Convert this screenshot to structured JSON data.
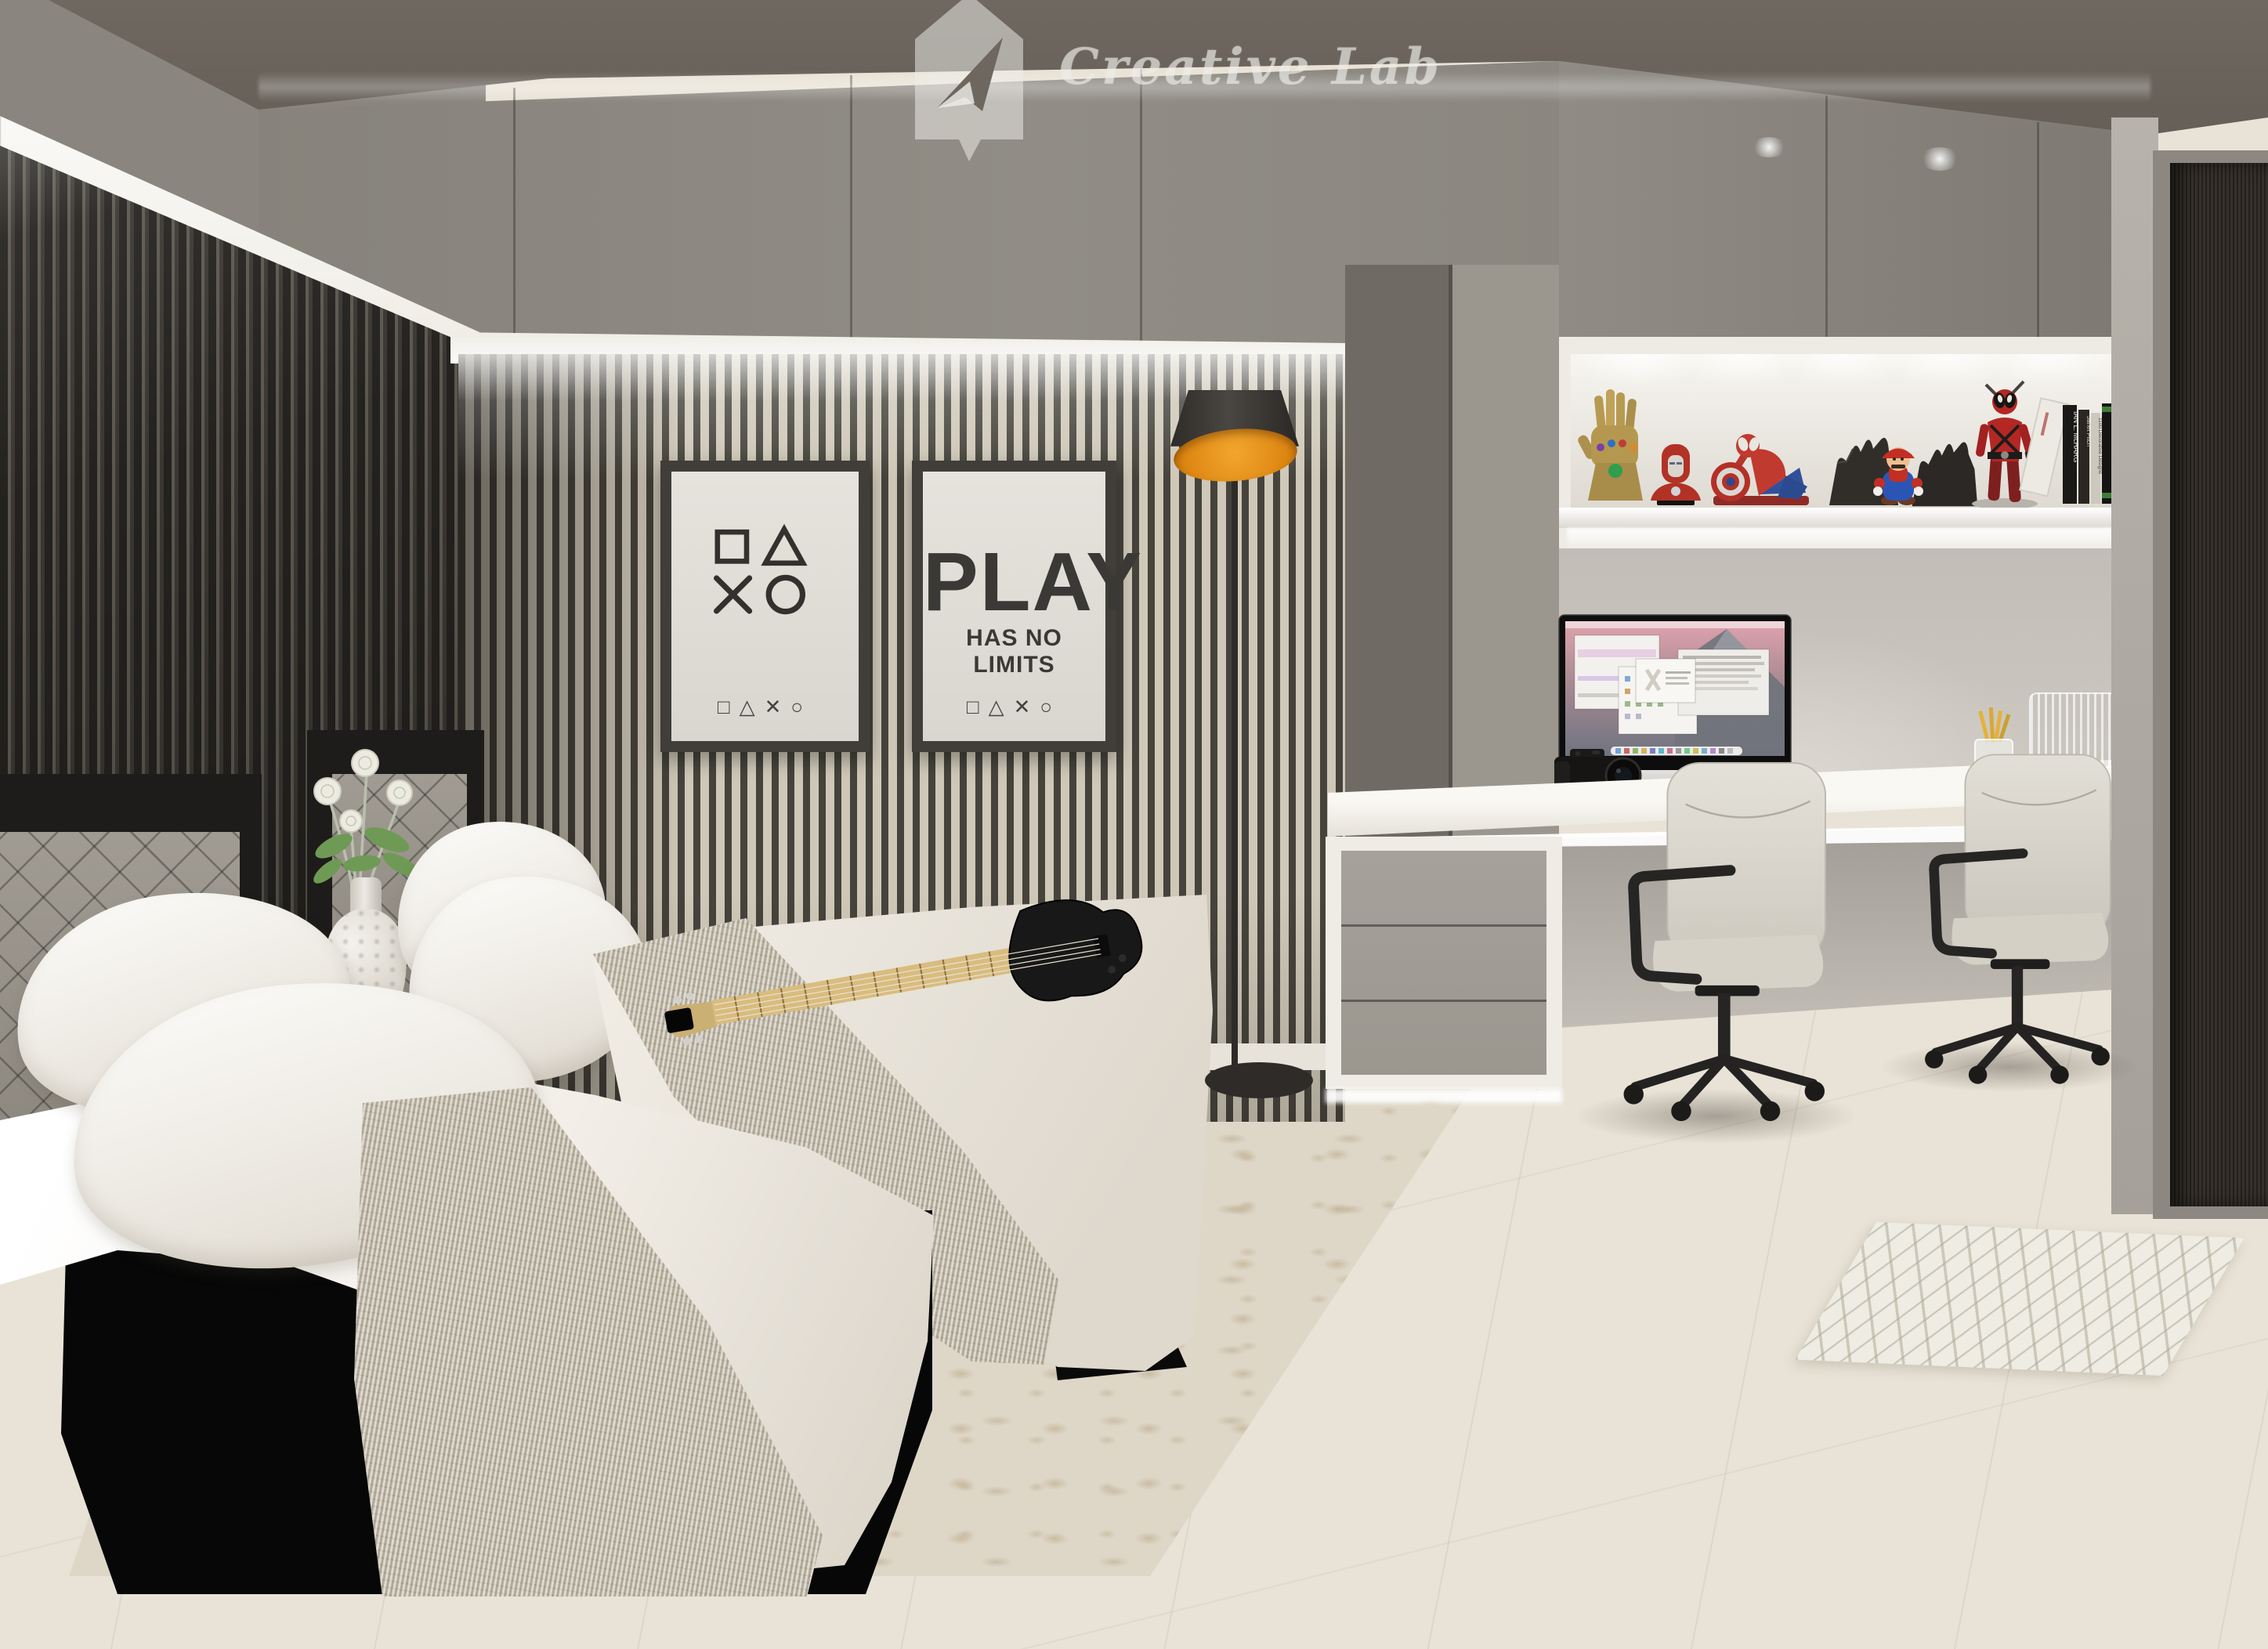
{
  "watermark": {
    "brand": "Creative Lab"
  },
  "posters": {
    "symbols": {
      "row1": "□ △",
      "row2": "✕ ○",
      "footer": "□△✕○"
    },
    "play": {
      "title": "PLAY",
      "subtitle": "HAS NO LIMITS",
      "footer": "□△✕○"
    }
  },
  "shelf": {
    "figures": [
      "infinity-gauntlet",
      "iron-man-bust",
      "spider-man-with-shield",
      "shadow-wolf",
      "shadow-wolf",
      "mario",
      "deadpool"
    ],
    "books": [
      "IAN L. McHARG",
      "Janet Fitch",
      "1100 Decorative Designs",
      "LENNARD J. DAVIS",
      "YOUNG HOUSE",
      "WHITE LINE FEVER"
    ]
  },
  "colors": {
    "ceiling": "#6b645c",
    "cabinet_gray": "#8b877f",
    "slat_light": "#cfc8b9",
    "slat_dark": "#46433c",
    "lamp_accent": "#e8941f",
    "door": "#36312b",
    "floor": "#e9e3d7",
    "bed_linen": "#f7f5f0",
    "chair_fabric": "#dcd8cf"
  }
}
